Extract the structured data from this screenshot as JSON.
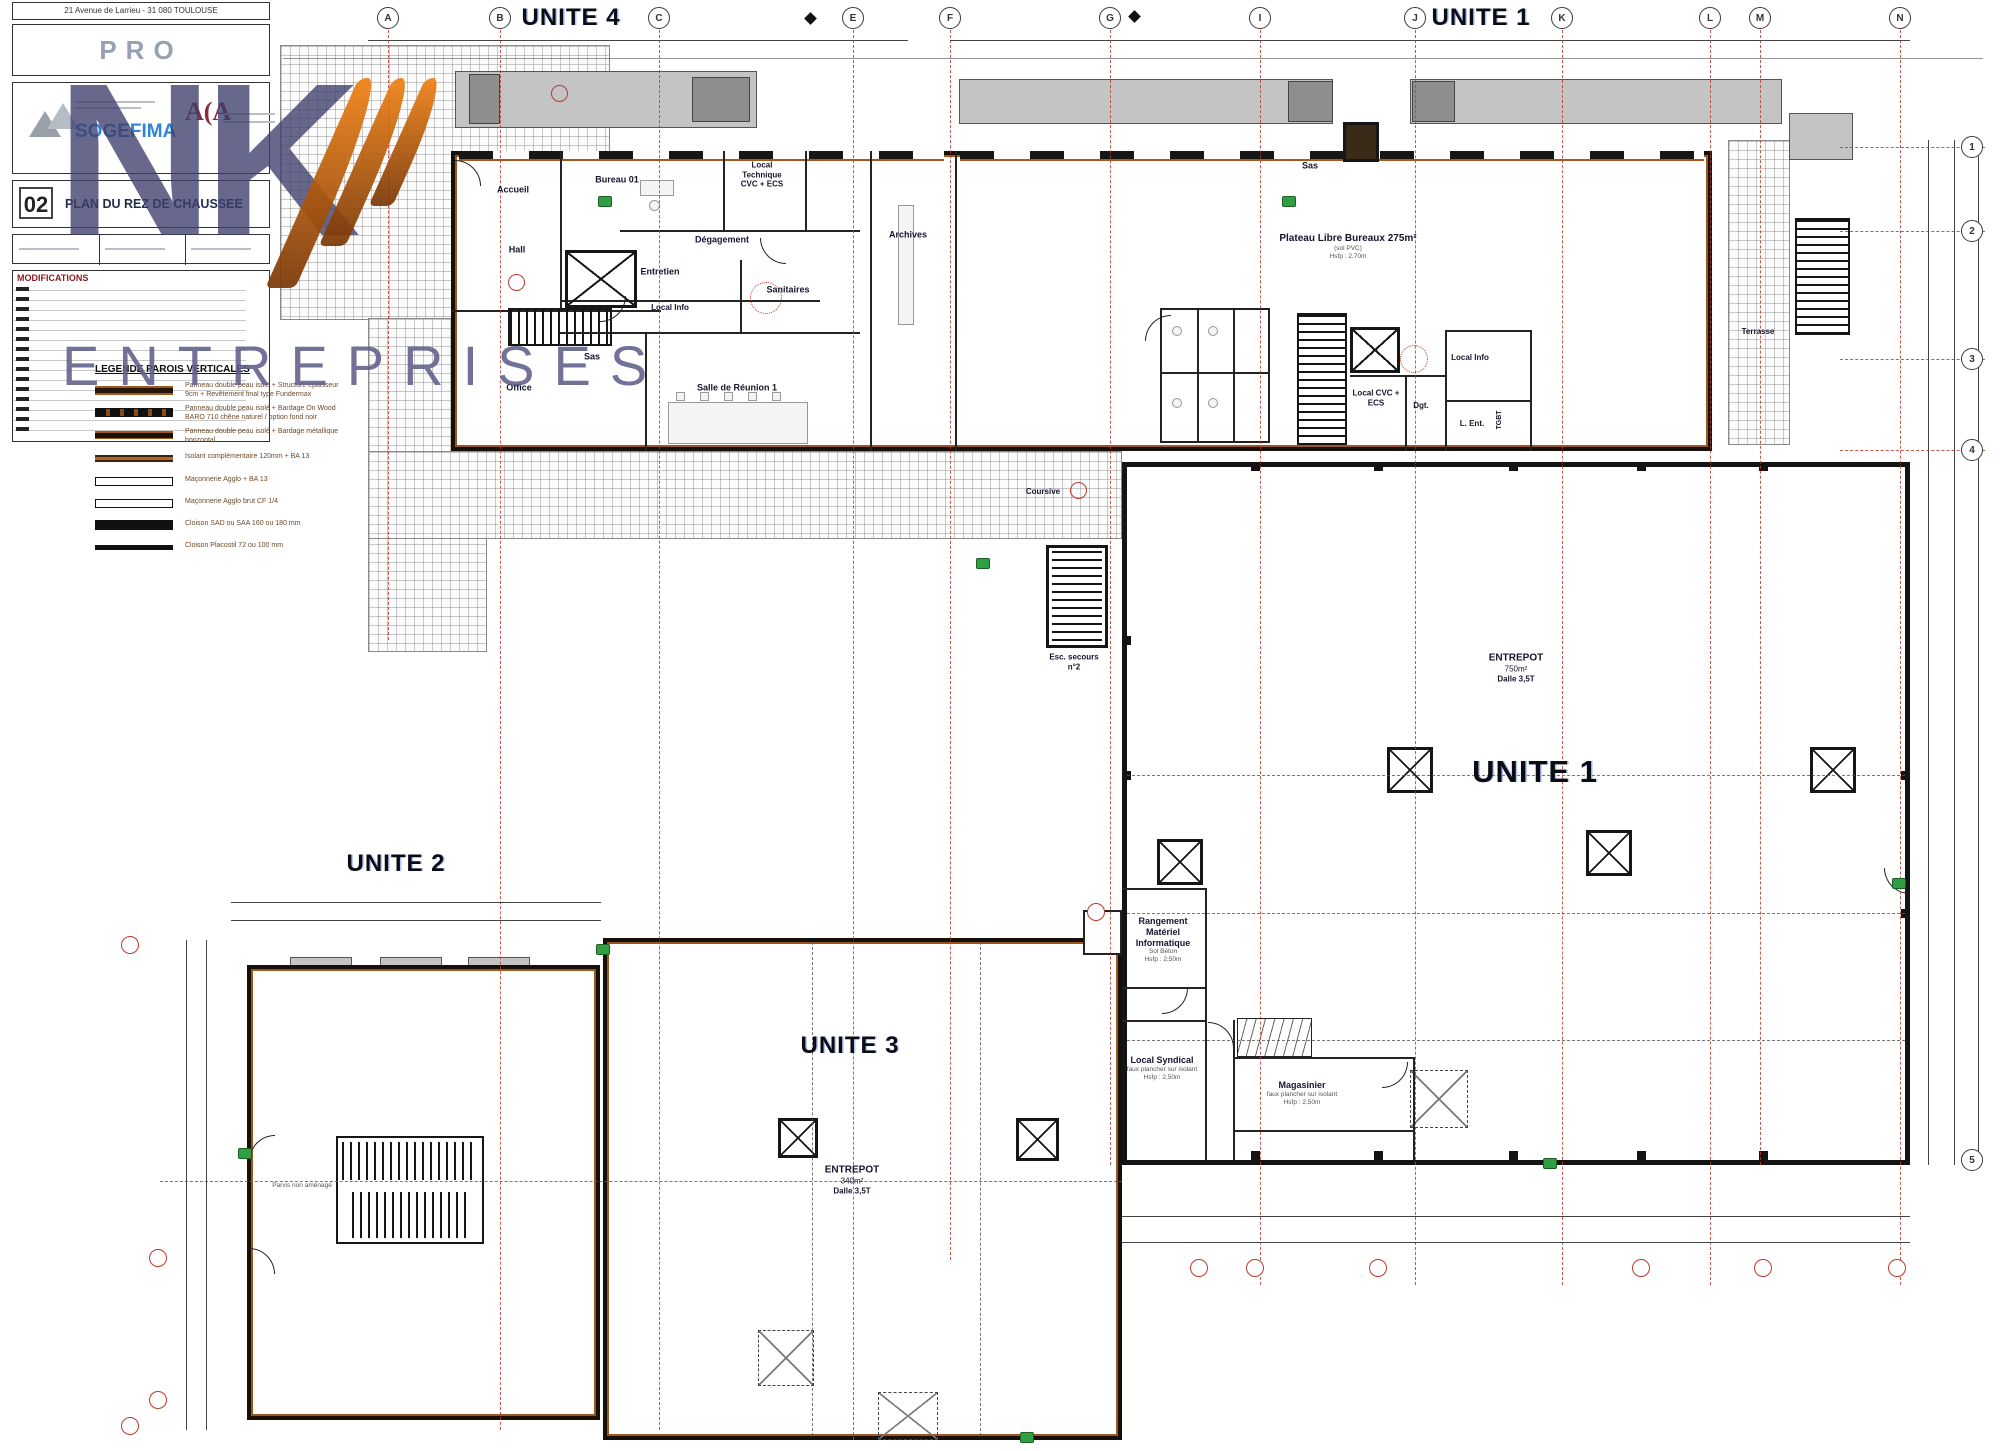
{
  "title_block": {
    "address": "21 Avenue de Larrieu - 31 080 TOULOUSE",
    "phase_label": "PRO",
    "firm_name": "SOGEFIMA",
    "architect_logo": "A(A",
    "sheet_number": "02",
    "sheet_title": "PLAN DU REZ DE CHAUSSEE",
    "modifications_label": "MODIFICATIONS"
  },
  "watermark": {
    "letters": "NK",
    "subtitle": "ENTREPRISES"
  },
  "legend": {
    "title": "LEGENDE PAROIS VERTICALES",
    "items": [
      {
        "label": "Panneau double peau isolé + Structure épaisseur 9cm + Revêtement final type Fundermax"
      },
      {
        "label": "Panneau double peau isolé + Bardage On Wood BARO 710 chêne naturel / option fond noir"
      },
      {
        "label": "Panneau double peau isolé + Bardage métallique horizontal"
      },
      {
        "label": "Isolant complémentaire 120mm + BA 13"
      },
      {
        "label": "Maçonnerie Agglo + BA 13"
      },
      {
        "label": "Maçonnerie Agglo brut CF 1/4"
      },
      {
        "label": "Cloison SAD ou SAA 160 ou 180 mm"
      },
      {
        "label": "Cloison Placostil 72 ou 100 mm"
      }
    ]
  },
  "unit_labels": {
    "unite4": "UNITE 4",
    "unite1_top": "UNITE 1",
    "unite1_hall": "UNITE 1",
    "unite2": "UNITE 2",
    "unite3": "UNITE 3"
  },
  "warehouses": {
    "w1": {
      "name": "ENTREPOT",
      "area": "750m²",
      "slab": "Dalle 3,5T"
    },
    "w3": {
      "name": "ENTREPOT",
      "area": "340m²",
      "slab": "Dalle 3,5T"
    }
  },
  "rooms": {
    "accueil": {
      "name": "Accueil"
    },
    "hall": {
      "name": "Hall"
    },
    "bureau01": {
      "name": "Bureau 01"
    },
    "local_technique": {
      "name": "Local Technique CVC + ECS"
    },
    "degagement": {
      "name": "Dégagement"
    },
    "archives": {
      "name": "Archives"
    },
    "entretien": {
      "name": "Entretien"
    },
    "local_info4": {
      "name": "Local Info"
    },
    "sanitaires": {
      "name": "Sanitaires"
    },
    "sas4": {
      "name": "Sas"
    },
    "office": {
      "name": "Office"
    },
    "salle_reunion": {
      "name": "Salle de Réunion 1"
    },
    "sas1": {
      "name": "Sas"
    },
    "plateau": {
      "name": "Plateau Libre Bureaux 275m²",
      "sub1": "(sol PVC)",
      "sub2": "Hsfp : 2,70m"
    },
    "local_info1": {
      "name": "Local Info"
    },
    "local_cvc": {
      "name": "Local CVC + ECS"
    },
    "dgt": {
      "name": "Dgt."
    },
    "l_ent": {
      "name": "L. Ent."
    },
    "tgbt": {
      "name": "TGBT"
    },
    "terrasse": {
      "name": "Terrasse"
    },
    "coursive": {
      "name": "Coursive"
    },
    "esc_secours": {
      "name": "Esc. secours n°2"
    },
    "rangement": {
      "name": "Rangement Matériel Informatique",
      "sub1": "Sol Béton",
      "sub2": "Hsfp : 2,50m"
    },
    "local_syndical": {
      "name": "Local Syndical",
      "sub1": "faux plancher sur isolant",
      "sub2": "Hsfp : 2,50m"
    },
    "magasinier": {
      "name": "Magasinier",
      "sub1": "faux plancher sur isolant",
      "sub2": "Hsfp : 2,50m"
    },
    "parvis": {
      "name": "Parvis non aménagé"
    }
  },
  "grid": {
    "top": [
      "A",
      "B",
      "C",
      "E",
      "F",
      "G",
      "I",
      "J",
      "K",
      "L",
      "M",
      "N"
    ],
    "right": [
      "1",
      "2",
      "3",
      "4",
      "5"
    ]
  },
  "colors": {
    "wall": "#17100a",
    "panel_orange": "#9c571c",
    "grid_red": "#c0392b",
    "canopy_gray": "#c4c4c4",
    "watermark_blue": "#3e3e6b",
    "watermark_orange": "#e0730f",
    "sogefima_blue": "#2f86d6",
    "aca_red": "#8b2a3a"
  }
}
